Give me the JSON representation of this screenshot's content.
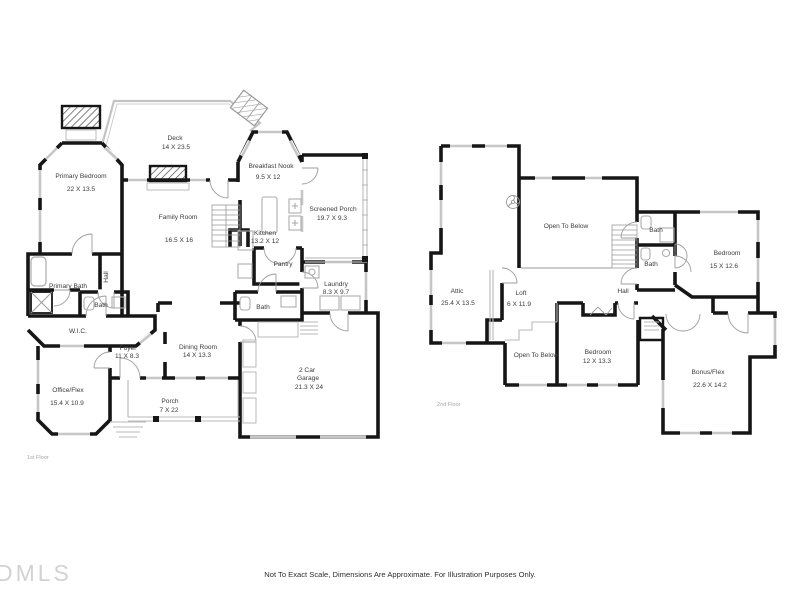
{
  "watermark": "DMLS",
  "footer": "Not To Exact Scale, Dimensions Are Approximate. For Illustration Purposes Only.",
  "colors": {
    "walls": "#161616",
    "details": "#c6c6c6",
    "labels": "#3b3b3b",
    "muted": "#a6a6a6"
  },
  "floors": [
    {
      "label": "1st Floor",
      "rooms": [
        {
          "name": "Deck",
          "dims": "14 X 23.5"
        },
        {
          "name": "Primary Bedroom",
          "dims": "22 X 13.5"
        },
        {
          "name": "Breakfast Nook",
          "dims": "9.5 X 12"
        },
        {
          "name": "Screened Porch",
          "dims": "19.7 X 9.3"
        },
        {
          "name": "Family Room",
          "dims": "16.5 X 16"
        },
        {
          "name": "Kitchen",
          "dims": "13.2 X 12"
        },
        {
          "name": "Pantry"
        },
        {
          "name": "Primary Bath"
        },
        {
          "name": "Hall"
        },
        {
          "name": "Bath"
        },
        {
          "name": "W.I.C."
        },
        {
          "name": "Laundry",
          "dims": "8.3 X 9.7"
        },
        {
          "name": "Bath"
        },
        {
          "name": "Foyer",
          "dims": "11 X 8.3"
        },
        {
          "name": "Dining Room",
          "dims": "14 X 13.3"
        },
        {
          "line1": "2 Car",
          "line2": "Garage",
          "dims": "21.3 X 24"
        },
        {
          "name": "Office/Flex",
          "dims": "15.4 X 10.9"
        },
        {
          "name": "Porch",
          "dims": "7 X 22"
        }
      ]
    },
    {
      "label": "2nd Floor",
      "rooms": [
        {
          "name": "Open To Below"
        },
        {
          "name": "Attic",
          "dims": "25.4 X 13.5"
        },
        {
          "name": "Loft",
          "dims": "6 X 11.9"
        },
        {
          "name": "Hall"
        },
        {
          "name": "Bath"
        },
        {
          "name": "Bath"
        },
        {
          "name": "Bedroom",
          "dims": "15 X 12.6"
        },
        {
          "name": "Open To Below"
        },
        {
          "name": "Bedroom",
          "dims": "12 X 13.3"
        },
        {
          "name": "Bonus/Flex",
          "dims": "22.6 X 14.2"
        }
      ]
    }
  ]
}
